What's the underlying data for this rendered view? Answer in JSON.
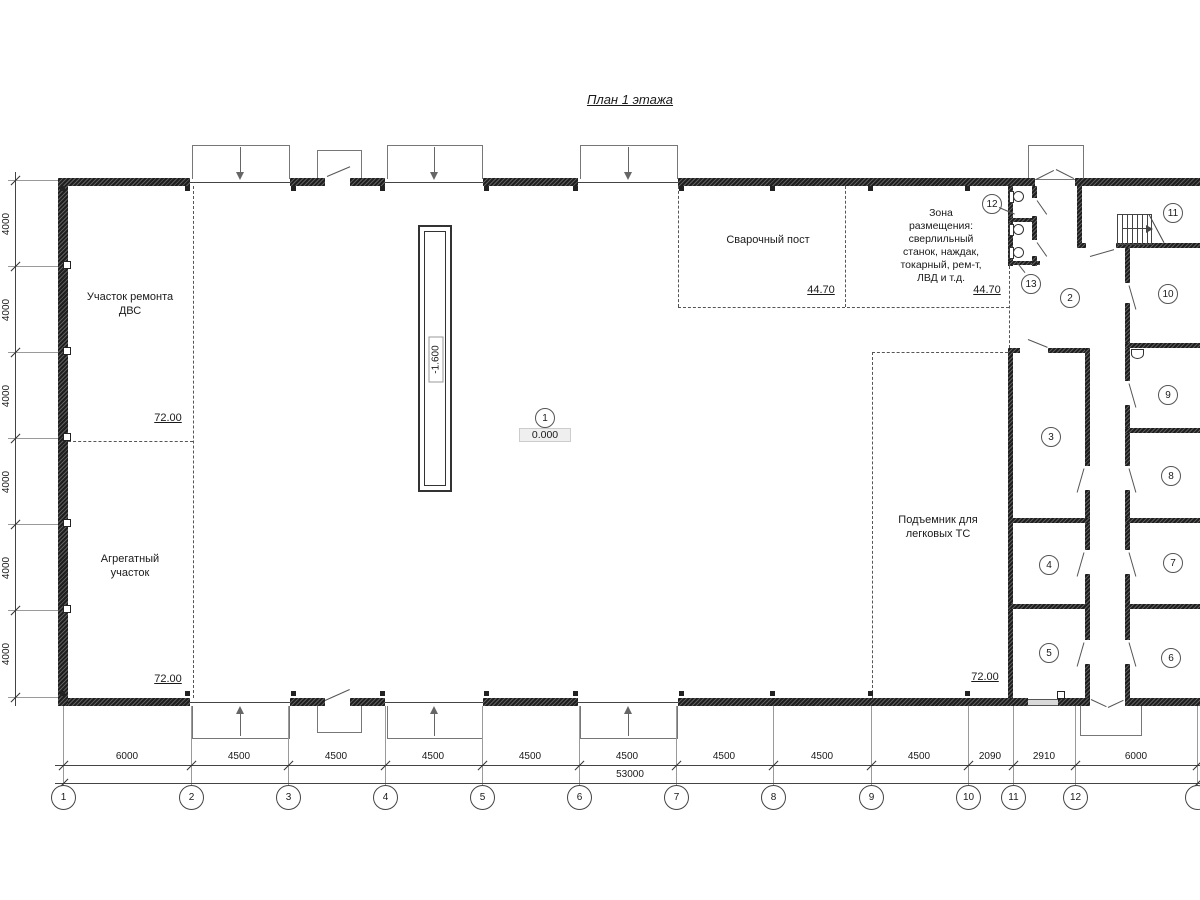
{
  "title": "План 1 этажа",
  "rooms": {
    "engine_repair": {
      "line1": "Участок ремонта",
      "line2": "ДВС",
      "area": "72.00"
    },
    "aggregate": {
      "line1": "Агрегатный",
      "line2": "участок",
      "area": "72.00"
    },
    "welding": {
      "name": "Сварочный пост",
      "area": "44.70"
    },
    "equipment_zone": {
      "line1": "Зона",
      "line2": "размещения:",
      "line3": "сверлильный",
      "line4": "станок, наждак,",
      "line5": "токарный, рем-т,",
      "line6": "ЛВД и т.д.",
      "area": "44.70"
    },
    "car_lift": {
      "line1": "Подъемник для",
      "line2": "легковых ТС",
      "area": "72.00"
    }
  },
  "levels": {
    "pit": "-1.600",
    "floor": "0.000"
  },
  "room_numbers": [
    "1",
    "2",
    "3",
    "4",
    "5",
    "6",
    "7",
    "8",
    "9",
    "10",
    "11",
    "12",
    "13"
  ],
  "axes_bottom": [
    "1",
    "2",
    "3",
    "4",
    "5",
    "6",
    "7",
    "8",
    "9",
    "10",
    "11",
    "12"
  ],
  "dims_bottom": [
    "6000",
    "4500",
    "4500",
    "4500",
    "4500",
    "4500",
    "4500",
    "4500",
    "4500",
    "2090",
    "2910",
    "6000"
  ],
  "dim_total": "53000",
  "dims_left": [
    "4000",
    "4000",
    "4000",
    "4000",
    "4000",
    "4000"
  ]
}
